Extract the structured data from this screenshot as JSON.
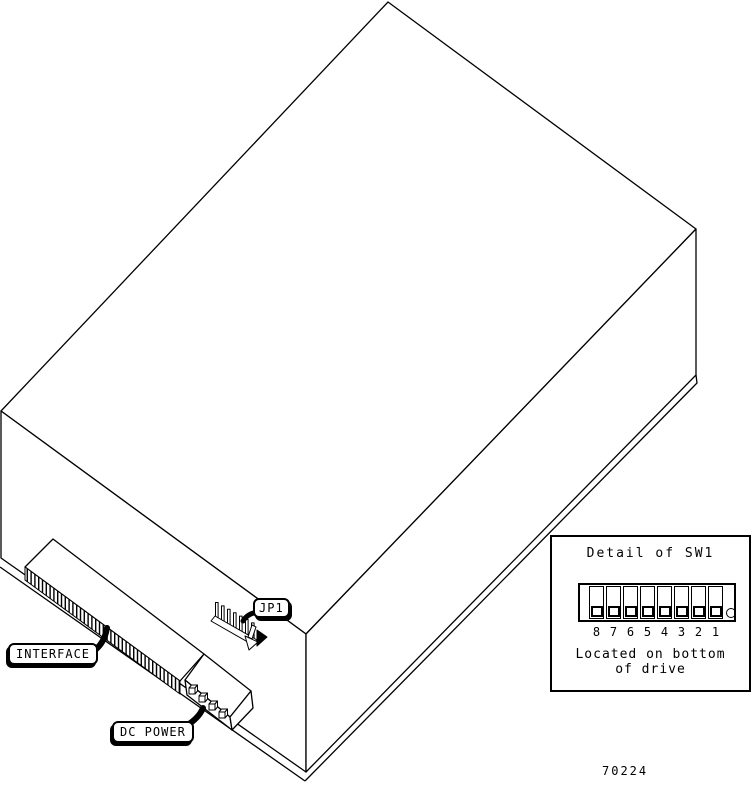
{
  "figure_number": "70224",
  "callouts": {
    "interface": "INTERFACE",
    "dc_power": "DC POWER",
    "jp1": "JP1"
  },
  "detail_box": {
    "title": "Detail of SW1",
    "switch_numbers": [
      "8",
      "7",
      "6",
      "5",
      "4",
      "3",
      "2",
      "1"
    ],
    "caption_line1": "Located on bottom",
    "caption_line2": "of drive"
  },
  "colors": {
    "line": "#000000",
    "background": "#ffffff"
  }
}
